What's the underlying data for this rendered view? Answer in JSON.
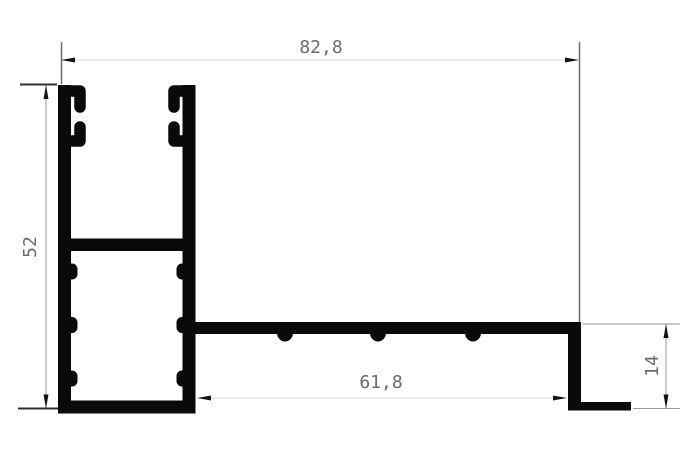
{
  "drawing": {
    "dimension_labels": {
      "top_width": "82,8",
      "left_height": "52",
      "bottom_width": "61,8",
      "right_height": "14"
    },
    "colors": {
      "background": "#ffffff",
      "profile_fill": "#0a0a0a",
      "dim_line_light": "#d9d9d9",
      "dim_line_mid": "#9a9a9a",
      "dim_line_dark": "#6a6a6a",
      "tick_line": "#2f2f2f",
      "arrow_fill": "#141414",
      "label_text": "#6b6b6b"
    }
  }
}
